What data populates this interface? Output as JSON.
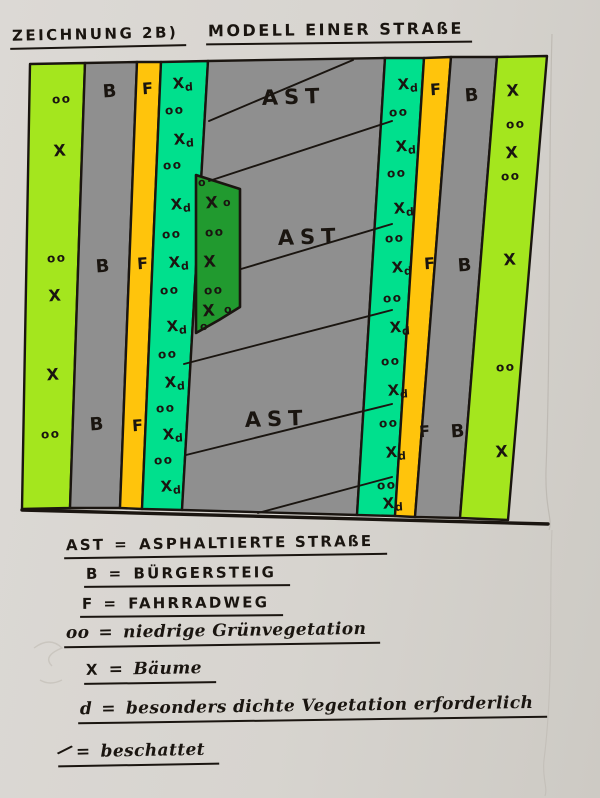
{
  "title": {
    "left": "ZEICHNUNG 2B)",
    "right": "MODELL EINER STRAßE"
  },
  "colors": {
    "paper": "#d7d4cf",
    "light_green": "#a4e61e",
    "gray": "#8f8f8f",
    "yellow": "#ffc40c",
    "teal_green": "#00e08d",
    "dark_green": "#219a2f",
    "ink": "#1a1510"
  },
  "diagram": {
    "ast_text": "AST",
    "ast_labels": [
      {
        "x": 262,
        "y": 105
      },
      {
        "x": 278,
        "y": 245
      },
      {
        "x": 245,
        "y": 427
      }
    ],
    "stripes": [
      {
        "name": "vegetation-strip-left",
        "color": "light_green",
        "pts": [
          [
            30,
            64
          ],
          [
            85,
            63
          ],
          [
            70,
            508
          ],
          [
            22,
            509
          ]
        ],
        "symbols": [
          {
            "t": "oo",
            "x": 62,
            "y": 103
          },
          {
            "t": "X",
            "x": 60,
            "y": 156
          },
          {
            "t": "oo",
            "x": 57,
            "y": 262
          },
          {
            "t": "X",
            "x": 55,
            "y": 301
          },
          {
            "t": "X",
            "x": 53,
            "y": 380
          },
          {
            "t": "oo",
            "x": 51,
            "y": 438
          }
        ]
      },
      {
        "name": "sidewalk-left",
        "color": "gray",
        "pts": [
          [
            85,
            63
          ],
          [
            137,
            62
          ],
          [
            120,
            508
          ],
          [
            70,
            508
          ]
        ],
        "symbols": [
          {
            "t": "B",
            "x": 110,
            "y": 97
          },
          {
            "t": "B",
            "x": 103,
            "y": 272
          },
          {
            "t": "B",
            "x": 97,
            "y": 430
          }
        ]
      },
      {
        "name": "bike-path-left",
        "color": "yellow",
        "pts": [
          [
            137,
            62
          ],
          [
            161,
            62
          ],
          [
            142,
            509
          ],
          [
            120,
            508
          ]
        ],
        "symbols": [
          {
            "t": "F",
            "x": 148,
            "y": 94
          },
          {
            "t": "F",
            "x": 143,
            "y": 269
          },
          {
            "t": "F",
            "x": 138,
            "y": 431
          }
        ]
      },
      {
        "name": "dense-green-strip-left",
        "color": "teal_green",
        "pts": [
          [
            161,
            62
          ],
          [
            208,
            61
          ],
          [
            182,
            510
          ],
          [
            142,
            509
          ]
        ],
        "symbols": [
          {
            "t": "Xd",
            "x": 183,
            "y": 88
          },
          {
            "t": "oo",
            "x": 175,
            "y": 114
          },
          {
            "t": "Xd",
            "x": 184,
            "y": 144
          },
          {
            "t": "oo",
            "x": 173,
            "y": 169
          },
          {
            "t": "Xd",
            "x": 181,
            "y": 209
          },
          {
            "t": "oo",
            "x": 172,
            "y": 238
          },
          {
            "t": "Xd",
            "x": 179,
            "y": 267
          },
          {
            "t": "oo",
            "x": 170,
            "y": 294
          },
          {
            "t": "Xd",
            "x": 177,
            "y": 331
          },
          {
            "t": "oo",
            "x": 168,
            "y": 358
          },
          {
            "t": "Xd",
            "x": 175,
            "y": 387
          },
          {
            "t": "oo",
            "x": 166,
            "y": 412
          },
          {
            "t": "Xd",
            "x": 173,
            "y": 439
          },
          {
            "t": "oo",
            "x": 164,
            "y": 464
          },
          {
            "t": "Xd",
            "x": 171,
            "y": 491
          }
        ]
      },
      {
        "name": "asphalt-road-center",
        "color": "gray",
        "pts": [
          [
            208,
            61
          ],
          [
            385,
            58
          ],
          [
            357,
            515
          ],
          [
            182,
            510
          ]
        ],
        "symbols": []
      },
      {
        "name": "dense-green-strip-right",
        "color": "teal_green",
        "pts": [
          [
            385,
            58
          ],
          [
            424,
            58
          ],
          [
            395,
            516
          ],
          [
            357,
            515
          ]
        ],
        "symbols": [
          {
            "t": "Xd",
            "x": 408,
            "y": 89
          },
          {
            "t": "oo",
            "x": 399,
            "y": 116
          },
          {
            "t": "Xd",
            "x": 406,
            "y": 151
          },
          {
            "t": "oo",
            "x": 397,
            "y": 177
          },
          {
            "t": "Xd",
            "x": 404,
            "y": 213
          },
          {
            "t": "oo",
            "x": 395,
            "y": 242
          },
          {
            "t": "Xd",
            "x": 402,
            "y": 272
          },
          {
            "t": "oo",
            "x": 393,
            "y": 302
          },
          {
            "t": "Xd",
            "x": 400,
            "y": 332
          },
          {
            "t": "oo",
            "x": 391,
            "y": 365
          },
          {
            "t": "Xd",
            "x": 398,
            "y": 395
          },
          {
            "t": "oo",
            "x": 389,
            "y": 427
          },
          {
            "t": "Xd",
            "x": 396,
            "y": 457
          },
          {
            "t": "oo",
            "x": 387,
            "y": 489
          },
          {
            "t": "Xd",
            "x": 393,
            "y": 508
          }
        ]
      },
      {
        "name": "bike-path-right",
        "color": "yellow",
        "pts": [
          [
            424,
            58
          ],
          [
            451,
            57
          ],
          [
            415,
            517
          ],
          [
            395,
            516
          ]
        ],
        "symbols": [
          {
            "t": "F",
            "x": 436,
            "y": 95
          },
          {
            "t": "F",
            "x": 430,
            "y": 269
          },
          {
            "t": "F",
            "x": 425,
            "y": 437
          }
        ]
      },
      {
        "name": "sidewalk-right",
        "color": "gray",
        "pts": [
          [
            451,
            57
          ],
          [
            497,
            57
          ],
          [
            460,
            518
          ],
          [
            415,
            517
          ]
        ],
        "symbols": [
          {
            "t": "B",
            "x": 472,
            "y": 101
          },
          {
            "t": "B",
            "x": 465,
            "y": 271
          },
          {
            "t": "B",
            "x": 458,
            "y": 437
          }
        ]
      },
      {
        "name": "vegetation-strip-right",
        "color": "light_green",
        "pts": [
          [
            497,
            57
          ],
          [
            547,
            56
          ],
          [
            508,
            520
          ],
          [
            460,
            518
          ]
        ],
        "symbols": [
          {
            "t": "X",
            "x": 513,
            "y": 96
          },
          {
            "t": "oo",
            "x": 516,
            "y": 128
          },
          {
            "t": "X",
            "x": 512,
            "y": 158
          },
          {
            "t": "oo",
            "x": 511,
            "y": 180
          },
          {
            "t": "X",
            "x": 510,
            "y": 265
          },
          {
            "t": "oo",
            "x": 506,
            "y": 371
          },
          {
            "t": "X",
            "x": 502,
            "y": 457
          }
        ]
      }
    ],
    "dark_patch": {
      "name": "dense-vegetation-patch",
      "color": "dark_green",
      "pts": [
        [
          196,
          175
        ],
        [
          240,
          189
        ],
        [
          240,
          307
        ],
        [
          219,
          320
        ],
        [
          196,
          333
        ]
      ],
      "symbols": [
        {
          "t": "o",
          "x": 202,
          "y": 186
        },
        {
          "t": "X",
          "x": 212,
          "y": 208
        },
        {
          "t": "o",
          "x": 227,
          "y": 206
        },
        {
          "t": "oo",
          "x": 215,
          "y": 236
        },
        {
          "t": "X",
          "x": 210,
          "y": 267
        },
        {
          "t": "oo",
          "x": 214,
          "y": 294
        },
        {
          "t": "X",
          "x": 209,
          "y": 316
        },
        {
          "t": "o",
          "x": 228,
          "y": 313
        },
        {
          "t": "o",
          "x": 204,
          "y": 330
        }
      ]
    },
    "shade_lines": [
      [
        209,
        121,
        353,
        60
      ],
      [
        209,
        181,
        392,
        121
      ],
      [
        241,
        269,
        392,
        224
      ],
      [
        184,
        364,
        392,
        310
      ],
      [
        186,
        455,
        392,
        404
      ],
      [
        258,
        513,
        392,
        477
      ]
    ],
    "baseline": [
      22,
      510,
      548,
      524
    ]
  },
  "legend": {
    "eq": "=",
    "rows": [
      {
        "sym": "AST",
        "def": "ASPHALTIERTE STRAßE"
      },
      {
        "sym": "B",
        "def": "BÜRGERSTEIG"
      },
      {
        "sym": "F",
        "def": "FAHRRADWEG"
      },
      {
        "sym": "oo",
        "def": "niedrige Grünvegetation"
      },
      {
        "sym": "X",
        "def": "Bäume"
      },
      {
        "sym": "d",
        "def": "besonders dichte Vegetation erforderlich"
      },
      {
        "sym": "/",
        "def": "beschattet"
      }
    ]
  }
}
